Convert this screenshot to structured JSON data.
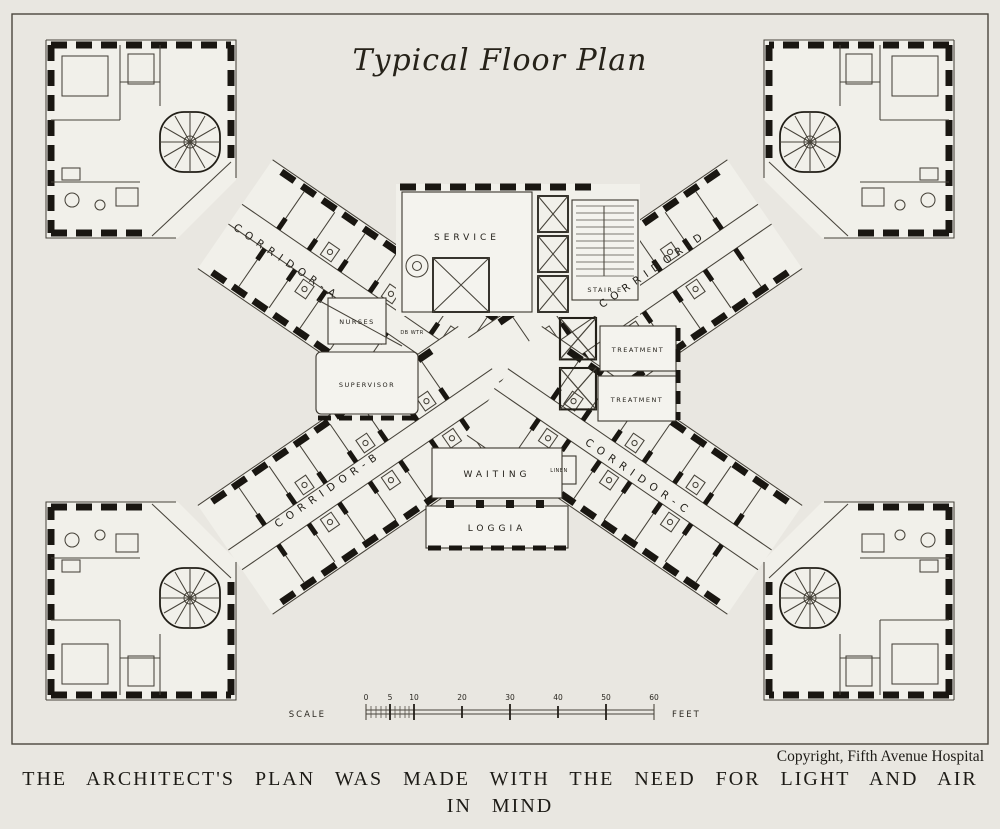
{
  "title": "Typical Floor Plan",
  "corridors": {
    "a": "CORRIDOR-A",
    "b": "CORRIDOR-B",
    "c": "CORRIDOR-C",
    "d": "CORRIDOR-D"
  },
  "rooms": {
    "service": "SERVICE",
    "stair_e": "STAIR E",
    "nurses": "NURSES",
    "dumbwaiter": "DB WTR",
    "supervisor": "SUPERVISOR",
    "treatment_upper": "TREATMENT",
    "treatment_lower": "TREATMENT",
    "linen": "LINEN",
    "waiting": "WAITING",
    "loggia": "LOGGIA"
  },
  "scale_bar": {
    "label": "SCALE",
    "unit": "FEET",
    "ticks": [
      "0",
      "5",
      "10",
      "20",
      "30",
      "40",
      "50",
      "60"
    ]
  },
  "copyright": "Copyright, Fifth Avenue Hospital",
  "caption_line1": "THE ARCHITECT'S PLAN WAS MADE WITH THE NEED FOR LIGHT AND AIR",
  "caption_line2": "IN MIND",
  "colors": {
    "paper": "#e9e7e1",
    "ink": "#191611"
  }
}
